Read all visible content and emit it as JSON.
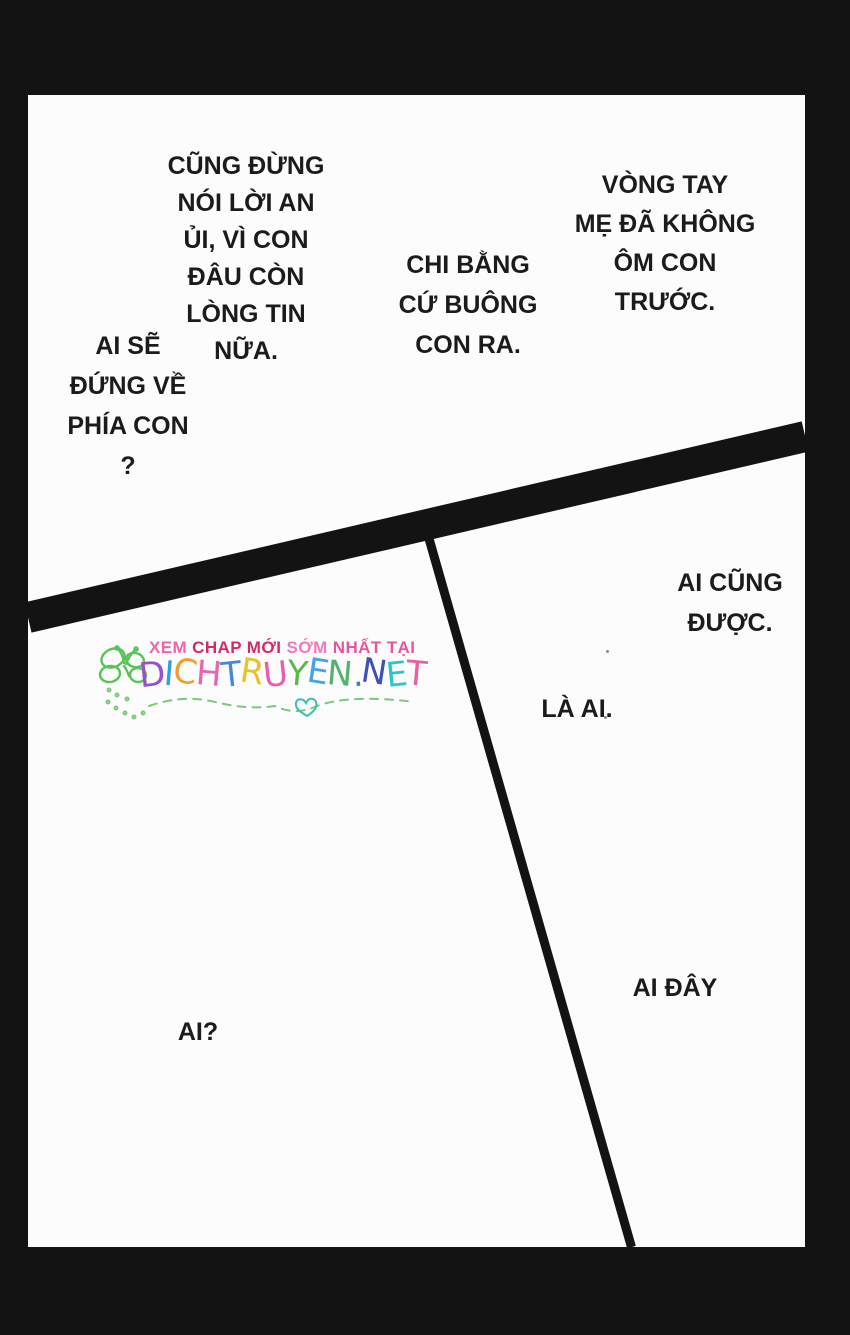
{
  "page": {
    "border_color": "#131313",
    "panel_color": "#fcfcfc",
    "text_color": "#1b1b1b"
  },
  "speech": {
    "bubbles": [
      {
        "id": "no-consolation",
        "text": "CŨNG ĐỪNG\nNÓI LỜI AN\nỦI, VÌ CON\nĐÂU CÒN\nLÒNG TIN\nNỮA."
      },
      {
        "id": "who-will-side",
        "text": "AI SẼ\nĐỨNG VỀ\nPHÍA CON\n?"
      },
      {
        "id": "better-let-go",
        "text": "CHI BẰNG\nCỨ BUÔNG\nCON RA."
      },
      {
        "id": "mothers-arms",
        "text": "VÒNG TAY\nMẸ ĐÃ KHÔNG\nÔM CON\nTRƯỚC."
      },
      {
        "id": "anyone-is-fine",
        "text": "AI CŨNG\nĐƯỢC."
      },
      {
        "id": "who-is-it",
        "text": "LÀ AI."
      },
      {
        "id": "someone-here",
        "text": "AI ĐÂY"
      },
      {
        "id": "who",
        "text": "AI?"
      }
    ]
  },
  "watermark": {
    "tagline_segments": [
      {
        "text": "XEM ",
        "color": "#ef64a8"
      },
      {
        "text": "CHAP MỚI ",
        "color": "#d62a62"
      },
      {
        "text": "SỚM ",
        "color": "#f07ab8"
      },
      {
        "text": "NHẤT TẠI",
        "color": "#e8559a"
      }
    ],
    "site_letters": [
      {
        "char": "D",
        "color": "#9a50cc"
      },
      {
        "char": "I",
        "color": "#2e9fe6"
      },
      {
        "char": "C",
        "color": "#f09f2e"
      },
      {
        "char": "H",
        "color": "#e667b0"
      },
      {
        "char": "T",
        "color": "#4a86d8"
      },
      {
        "char": "R",
        "color": "#e6c22e"
      },
      {
        "char": "U",
        "color": "#e65fa8"
      },
      {
        "char": "Y",
        "color": "#5cb648"
      },
      {
        "char": "E",
        "color": "#47a2ea"
      },
      {
        "char": "N",
        "color": "#52b468"
      },
      {
        "char": ".",
        "color": "#3a7fd6"
      },
      {
        "char": "N",
        "color": "#3f51b5"
      },
      {
        "char": "E",
        "color": "#2ec6c6"
      },
      {
        "char": "T",
        "color": "#ea5fa0"
      }
    ],
    "doodle_colors": {
      "butterfly": "#58c458",
      "trail": "#7cc87c",
      "heart": "#3cc0ae"
    }
  }
}
